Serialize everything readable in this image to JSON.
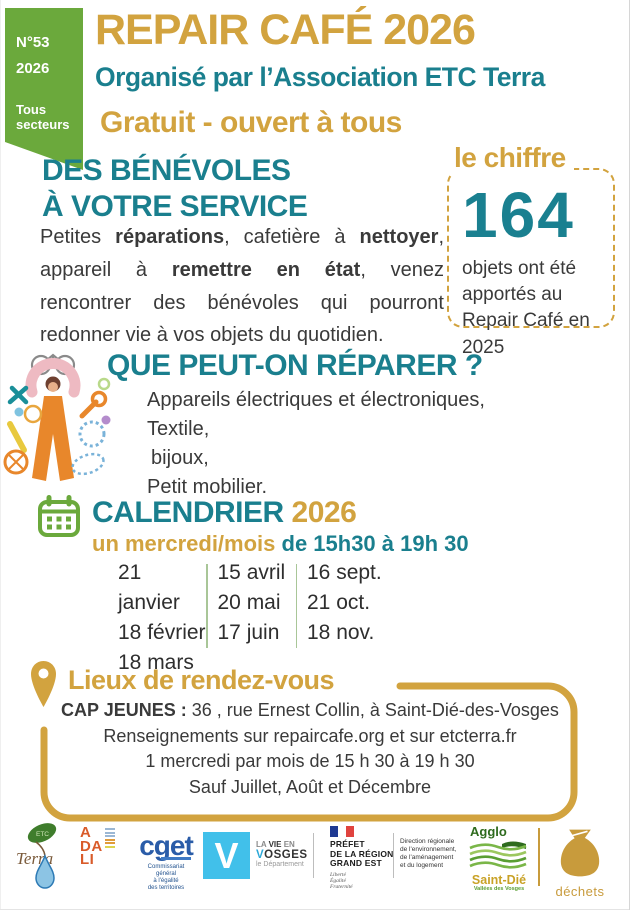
{
  "colors": {
    "gold": "#D2A33F",
    "teal": "#1A7F8E",
    "green": "#6BA93C"
  },
  "badge": {
    "number": "N°53",
    "year": "2026",
    "sector_line1": "Tous",
    "sector_line2": "secteurs"
  },
  "header": {
    "title": "REPAIR CAFÉ 2026",
    "subtitle": "Organisé par l’Association ETC Terra",
    "tagline": "Gratuit - ouvert à tous"
  },
  "volunteers": {
    "heading_line1": "DES BÉNÉVOLES",
    "heading_line2": "À VOTRE SERVICE",
    "para": {
      "t1": "Petites ",
      "b1": "réparations",
      "t2": ", cafetière à ",
      "b2": "nettoyer",
      "t3": ", appareil à ",
      "b3": "remettre en état",
      "t4": ", venez rencontrer des bénévoles qui pourront redonner vie à vos objets du quotidien."
    }
  },
  "stat": {
    "label": "le chiffre",
    "value": "164",
    "caption": "objets ont été apportés au  Repair Café en 2025"
  },
  "repair": {
    "heading": "QUE PEUT-ON RÉPARER ?",
    "items": [
      "Appareils électriques et électroniques,",
      "Textile,",
      "bijoux,",
      "Petit mobilier."
    ]
  },
  "calendar": {
    "title": "CALENDRIER",
    "year": "2026",
    "when_gold": "un mercredi/mois",
    "when_teal": " de 15h30 à 19h 30",
    "columns": [
      [
        "21 janvier",
        "18 février",
        "18 mars"
      ],
      [
        "15 avril",
        "20 mai",
        "17 juin"
      ],
      [
        "16 sept.",
        "21 oct.",
        "18 nov."
      ]
    ]
  },
  "location": {
    "heading": "Lieux de rendez-vous",
    "line1_bold": "CAP JEUNES :",
    "line1_rest": " 36 , rue Ernest Collin, à Saint-Dié-des-Vosges",
    "line2": "Renseignements sur repaircafe.org et sur etcterra.fr",
    "line3": "1 mercredi par mois de 15 h 30 à 19 h 30",
    "line4": "Sauf  Juillet, Août et Décembre"
  },
  "partners": {
    "etcterra": {
      "leaf": "ETC",
      "name": "Terra"
    },
    "adali": {
      "l1": "A",
      "l2": "DA",
      "l3": "LI"
    },
    "cget": {
      "name": "cget",
      "cap1": "Commissariat",
      "cap2": "général",
      "cap3": "à l'égalité",
      "cap4": "des territoires"
    },
    "vosges": {
      "letter": "V",
      "line1_pre": "LA ",
      "line1_bold": "VIE",
      "line1_post": " EN",
      "line2_v": "V",
      "line2_rest": "OSGES",
      "line3": "le Département"
    },
    "prefet": {
      "line1": "PRÉFET",
      "line2": "DE LA RÉGION",
      "line3": "GRAND EST",
      "motto1": "Liberté",
      "motto2": "Égalité",
      "motto3": "Fraternité"
    },
    "dreal": {
      "line1": "Direction régionale",
      "line2": "de l'environnement,",
      "line3": "de l'aménagement",
      "line4": "et du logement"
    },
    "agglo": {
      "line1": "Agglo",
      "line2": "Saint-Dié",
      "line3": "Vallées des Vosges"
    },
    "dechets": {
      "label": "déchets"
    }
  }
}
